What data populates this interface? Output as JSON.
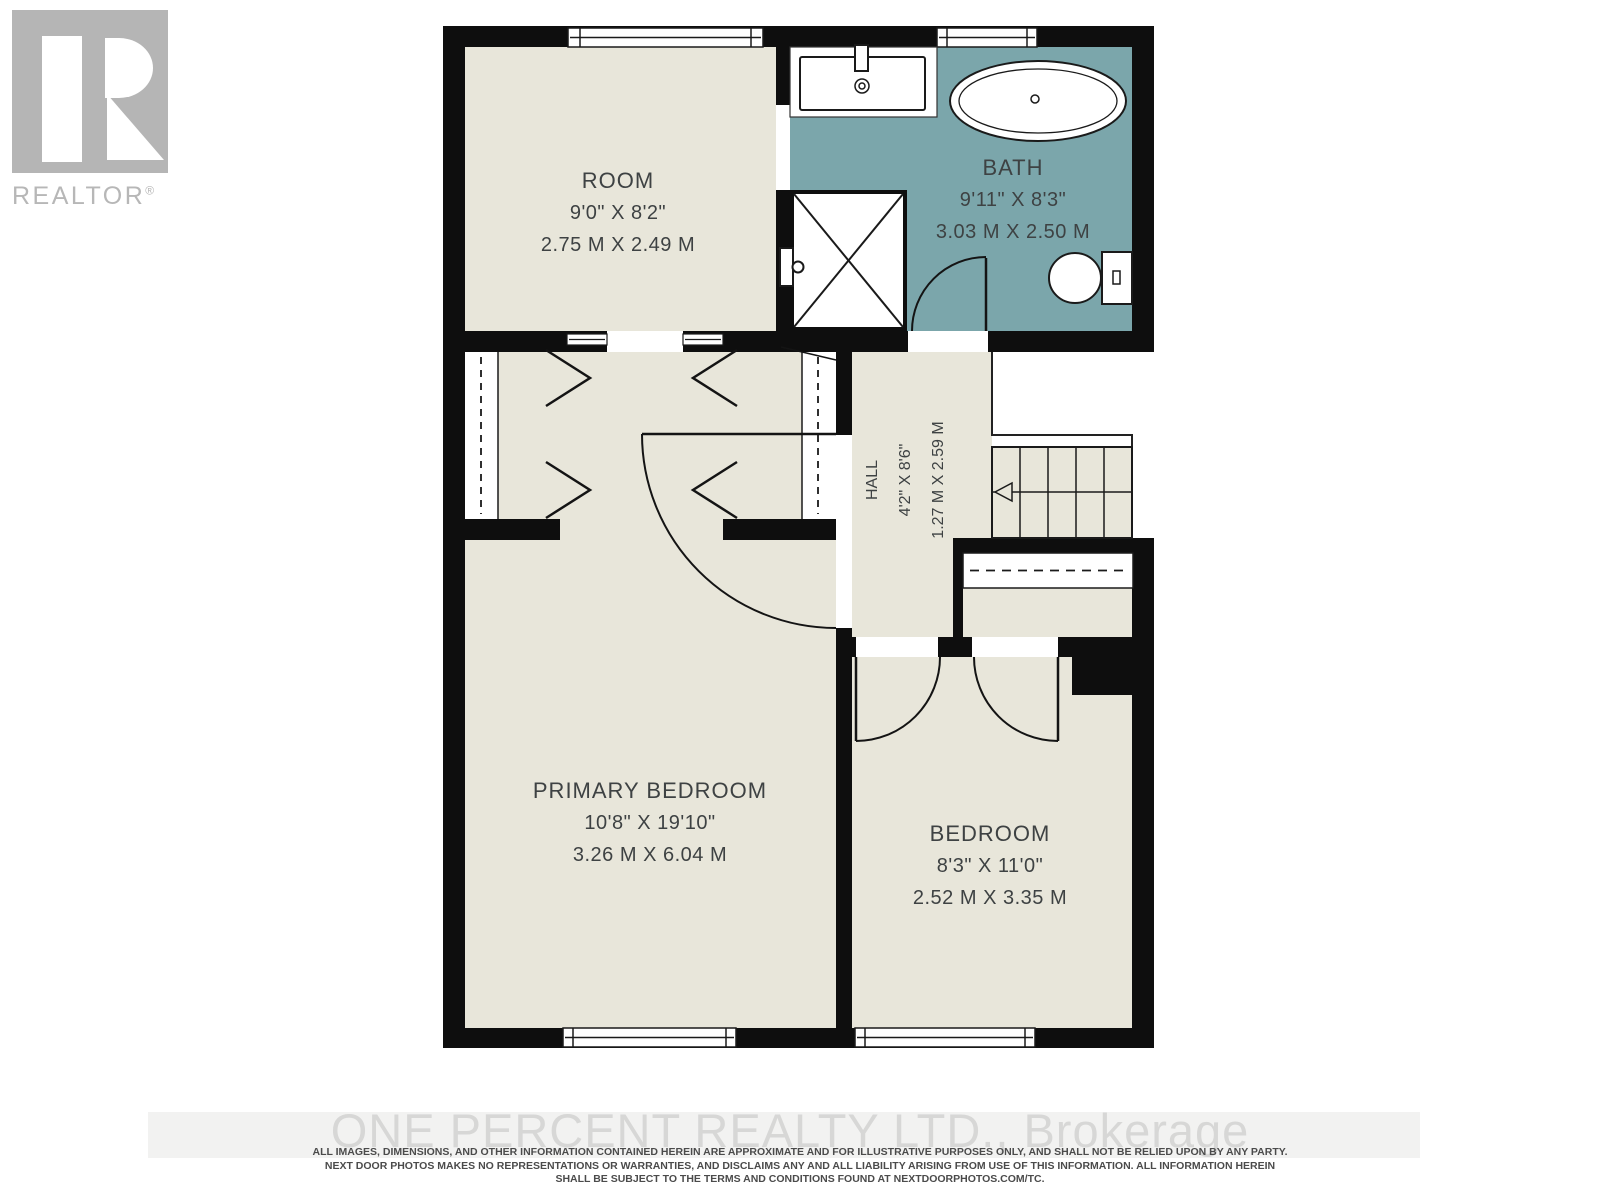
{
  "branding": {
    "logo_text": "REALTOR",
    "registered": "®",
    "watermark": "ONE PERCENT REALTY LTD., Brokerage"
  },
  "rooms": {
    "room": {
      "name": "ROOM",
      "imperial": "9'0\" X 8'2\"",
      "metric": "2.75 M X 2.49 M"
    },
    "bath": {
      "name": "BATH",
      "imperial": "9'11\" X 8'3\"",
      "metric": "3.03 M X 2.50 M"
    },
    "hall": {
      "name": "HALL",
      "imperial": "4'2\" X 8'6\"",
      "metric": "1.27 M X 2.59 M"
    },
    "primary_bedroom": {
      "name": "PRIMARY BEDROOM",
      "imperial": "10'8\" X 19'10\"",
      "metric": "3.26 M X 6.04 M"
    },
    "bedroom": {
      "name": "BEDROOM",
      "imperial": "8'3\" X 11'0\"",
      "metric": "2.52 M X 3.35 M"
    }
  },
  "footer": {
    "disclaimer_line1": "ALL IMAGES, DIMENSIONS, AND OTHER INFORMATION CONTAINED HEREIN ARE APPROXIMATE AND FOR ILLUSTRATIVE PURPOSES ONLY, AND SHALL NOT BE RELIED UPON BY ANY PARTY.",
    "disclaimer_line2": "NEXT DOOR PHOTOS MAKES NO REPRESENTATIONS OR WARRANTIES, AND DISCLAIMS ANY AND ALL LIABILITY ARISING FROM USE OF THIS INFORMATION. ALL INFORMATION HEREIN",
    "disclaimer_line3": "SHALL BE SUBJECT TO THE TERMS AND CONDITIONS FOUND AT NEXTDOORPHOTOS.COM/TC."
  },
  "colors": {
    "floor": "#e8e6da",
    "bath_floor": "#7ba6ab",
    "wall": "#0e0e0e",
    "line": "#1a1a1a",
    "logo_gray": "#b5b5b5",
    "watermark_gray": "#d7d7d6",
    "label_text": "#3e4243",
    "disclaimer_text": "#4b4b4b"
  }
}
